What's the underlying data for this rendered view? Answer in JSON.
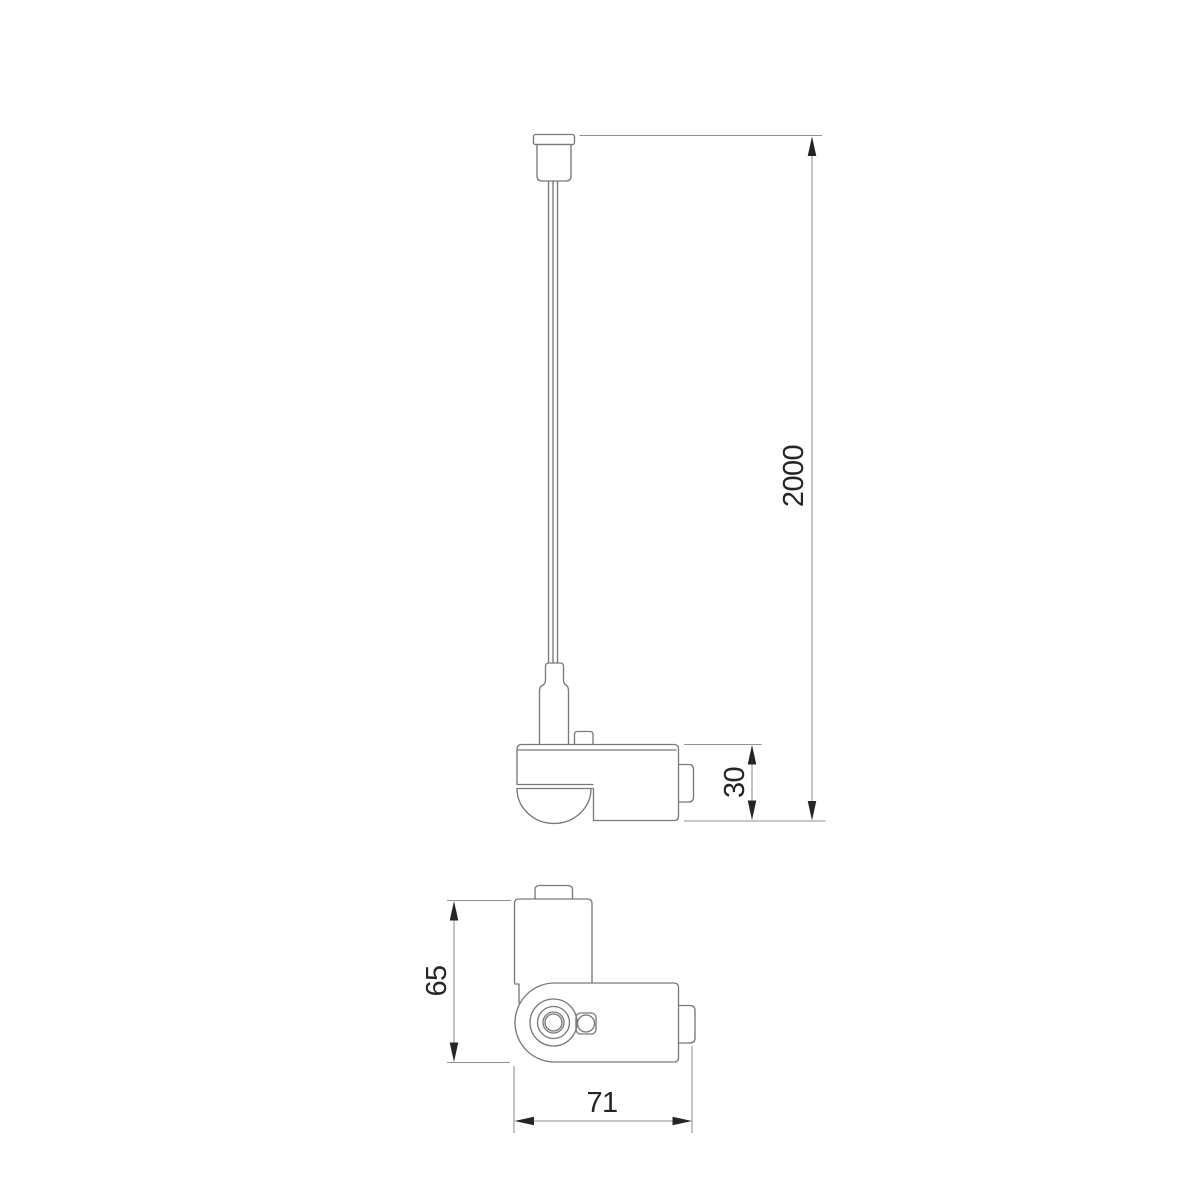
{
  "drawing": {
    "kind": "technical-dimension-drawing",
    "subject": "pendant track adapter with suspension cable, side view and bottom view",
    "dimensions": {
      "suspension_length": "2000",
      "adapter_body_height": "30",
      "adapter_overall_height": "65",
      "adapter_overall_width": "71"
    },
    "colors": {
      "background": "#ffffff",
      "object_line": "#77797b",
      "dimension_line": "#909294",
      "text_and_arrows": "#232527"
    }
  }
}
